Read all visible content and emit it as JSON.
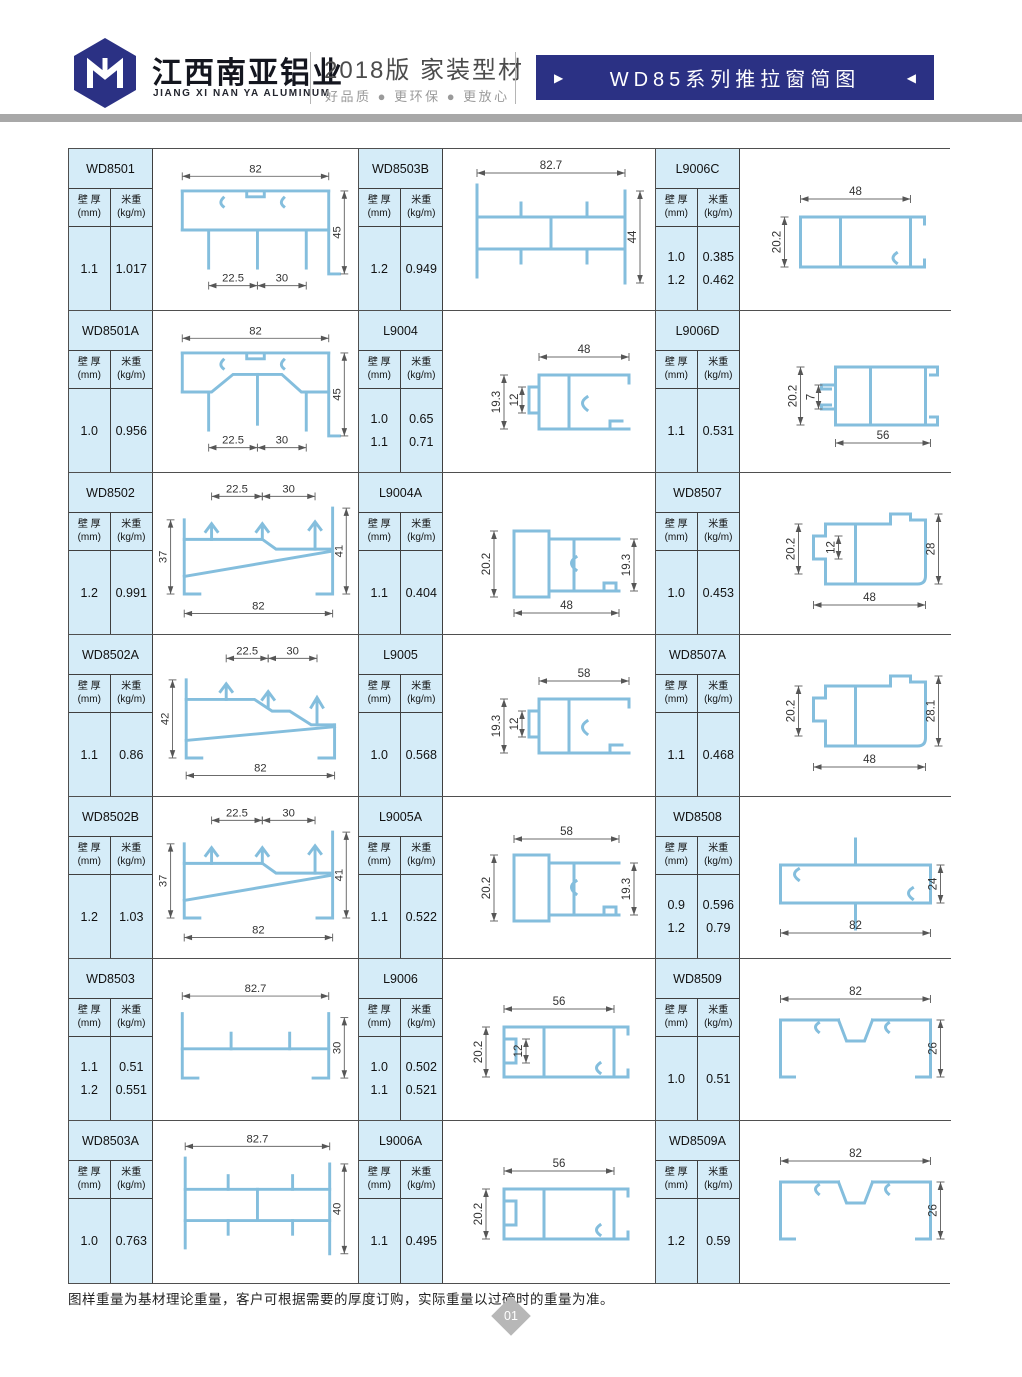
{
  "header": {
    "brand_cn": "江西南亚铝业",
    "brand_en": "JIANG XI NAN YA ALUMINUM",
    "edition": "2018版  家装型材",
    "slogan": "好品质 ● 更环保 ● 更放心",
    "banner_title": "WD85系列推拉窗简图",
    "banner_left_arrow": "▶",
    "banner_right_arrow": "◀",
    "navy_color": "#2b3184",
    "profile_blue": "#84bedd"
  },
  "table_labels": {
    "thickness_l1": "壁 厚",
    "thickness_l2": "(mm)",
    "weight_l1": "米重",
    "weight_l2": "(kg/m)"
  },
  "cells": [
    {
      "model": "WD8501",
      "shape": "topTrack",
      "values": [
        [
          "1.1",
          "1.017"
        ]
      ],
      "dims": [
        "82",
        "45",
        "22.5",
        "30"
      ]
    },
    {
      "model": "WD8503B",
      "shape": "hFrame",
      "values": [
        [
          "1.2",
          "0.949"
        ]
      ],
      "dims": [
        "82.7",
        "44"
      ]
    },
    {
      "model": "L9006C",
      "shape": "boxChannel",
      "values": [
        [
          "1.0",
          "0.385"
        ],
        [
          "1.2",
          "0.462"
        ]
      ],
      "dims": [
        "48",
        "20.2"
      ]
    },
    {
      "model": "WD8501A",
      "shape": "topTrackHump",
      "values": [
        [
          "1.0",
          "0.956"
        ]
      ],
      "dims": [
        "82",
        "45",
        "22.5",
        "30"
      ]
    },
    {
      "model": "L9004",
      "shape": "railSmall",
      "values": [
        [
          "1.0",
          "0.65"
        ],
        [
          "1.1",
          "0.71"
        ]
      ],
      "dims": [
        "48",
        "19.3",
        "12"
      ]
    },
    {
      "model": "L9006D",
      "shape": "boxChannelD",
      "values": [
        [
          "1.1",
          "0.531"
        ]
      ],
      "dims": [
        "20.2",
        "7",
        "56"
      ]
    },
    {
      "model": "WD8502",
      "shape": "sill5",
      "values": [
        [
          "1.2",
          "0.991"
        ]
      ],
      "dims": [
        "22.5",
        "30",
        "37",
        "41",
        "82"
      ]
    },
    {
      "model": "L9004A",
      "shape": "railB_b",
      "values": [
        [
          "1.1",
          "0.404"
        ]
      ],
      "dims": [
        "20.2",
        "19.3",
        "48"
      ]
    },
    {
      "model": "WD8507",
      "shape": "cornerBox4",
      "values": [
        [
          "1.0",
          "0.453"
        ]
      ],
      "dims": [
        "20.2",
        "12",
        "28",
        "48"
      ]
    },
    {
      "model": "WD8502A",
      "shape": "sill4",
      "values": [
        [
          "1.1",
          "0.86"
        ]
      ],
      "dims": [
        "22.5",
        "30",
        "42",
        "82"
      ]
    },
    {
      "model": "L9005",
      "shape": "railSmall",
      "values": [
        [
          "1.0",
          "0.568"
        ]
      ],
      "dims": [
        "58",
        "19.3",
        "12"
      ]
    },
    {
      "model": "WD8507A",
      "shape": "cornerBox3",
      "values": [
        [
          "1.1",
          "0.468"
        ]
      ],
      "dims": [
        "20.2",
        "28.1",
        "48"
      ]
    },
    {
      "model": "WD8502B",
      "shape": "sill5",
      "values": [
        [
          "1.2",
          "1.03"
        ]
      ],
      "dims": [
        "22.5",
        "30",
        "37",
        "41",
        "82"
      ]
    },
    {
      "model": "L9005A",
      "shape": "railB_t",
      "values": [
        [
          "1.1",
          "0.522"
        ]
      ],
      "dims": [
        "58",
        "20.2",
        "19.3"
      ]
    },
    {
      "model": "WD8508",
      "shape": "flatBox",
      "values": [
        [
          "0.9",
          "0.596"
        ],
        [
          "1.2",
          "0.79"
        ]
      ],
      "dims": [
        "24",
        "82"
      ]
    },
    {
      "model": "WD8503",
      "shape": "bottomChannel",
      "values": [
        [
          "1.1",
          "0.51"
        ],
        [
          "1.2",
          "0.551"
        ]
      ],
      "dims": [
        "82.7",
        "30"
      ]
    },
    {
      "model": "L9006",
      "shape": "boxChannelI",
      "values": [
        [
          "1.0",
          "0.502"
        ],
        [
          "1.1",
          "0.521"
        ]
      ],
      "dims": [
        "56",
        "20.2",
        "12"
      ]
    },
    {
      "model": "WD8509",
      "shape": "wideChannel",
      "values": [
        [
          "1.0",
          "0.51"
        ]
      ],
      "dims": [
        "82",
        "26"
      ]
    },
    {
      "model": "WD8503A",
      "shape": "hFrame",
      "values": [
        [
          "1.0",
          "0.763"
        ]
      ],
      "dims": [
        "82.7",
        "40"
      ]
    },
    {
      "model": "L9006A",
      "shape": "boxChannelI2",
      "values": [
        [
          "1.1",
          "0.495"
        ]
      ],
      "dims": [
        "56",
        "20.2"
      ]
    },
    {
      "model": "WD8509A",
      "shape": "wideChannel",
      "values": [
        [
          "1.2",
          "0.59"
        ]
      ],
      "dims": [
        "82",
        "26"
      ]
    }
  ],
  "footer": {
    "note": "图样重量为基材理论重量，客户可根据需要的厚度订购，实际重量以过磅时的重量为准。",
    "page_number": "01"
  }
}
